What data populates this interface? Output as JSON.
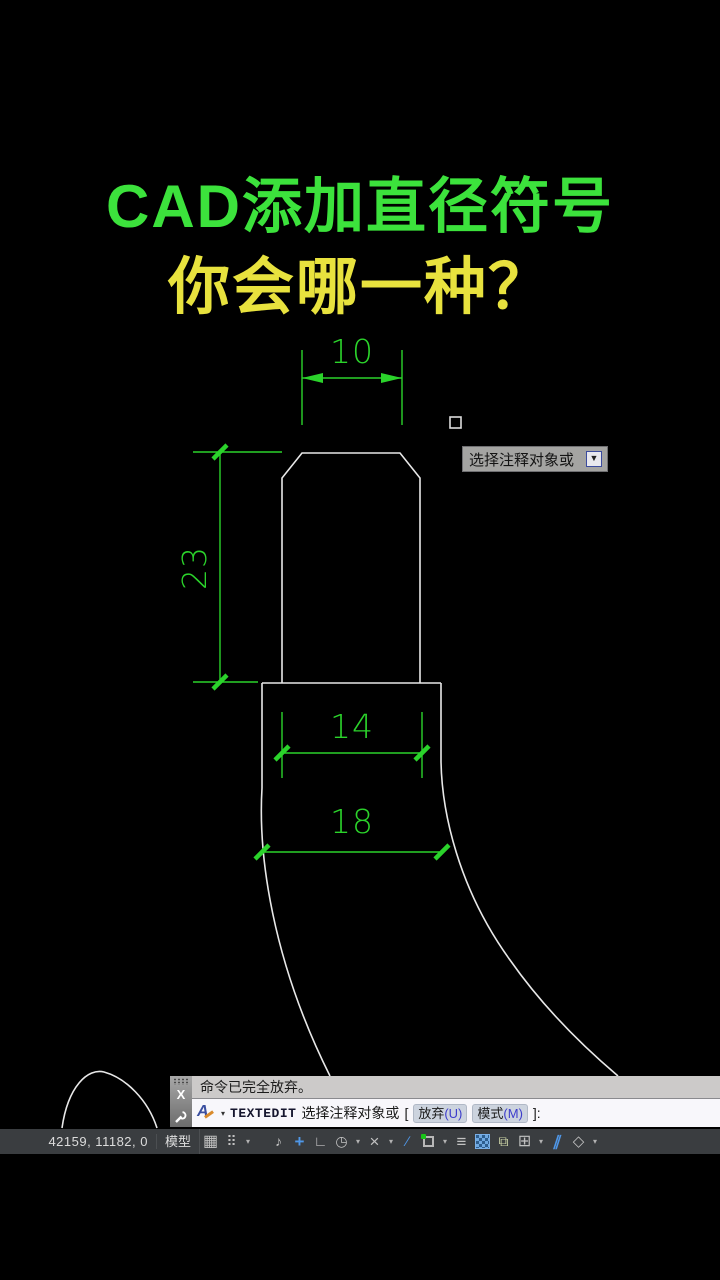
{
  "title": {
    "line1": "CAD添加直径符号",
    "line2": "你会哪一种？",
    "line1_color": "#3ce23c",
    "line2_color": "#e8e23e"
  },
  "drawing": {
    "dimension_color": "#2bd32b",
    "outline_color": "#e8e8e8",
    "dimensions": {
      "top_width": "10",
      "height": "23",
      "inner_width": "14",
      "outer_width": "18"
    }
  },
  "tooltip": {
    "text": "选择注释对象或",
    "key_icon": "▼"
  },
  "command_window": {
    "close_label": "X",
    "history_line": "命令已完全放弃。",
    "prompt": {
      "command": "TEXTEDIT",
      "text": "选择注释对象或",
      "bracket_open": "[",
      "options": [
        {
          "name": "放弃",
          "key": "(U)"
        },
        {
          "name": "模式",
          "key": "(M)"
        }
      ],
      "bracket_close": "]:",
      "caret": "▾"
    }
  },
  "status_bar": {
    "coordinates": "42159, 11182, 0",
    "model_button": "模型",
    "icons": {
      "grid": {
        "glyph": "▦"
      },
      "snap": {
        "glyph": "⠿",
        "dropdown": "▾"
      },
      "infer": {
        "glyph": "♪"
      },
      "dyninput": {
        "glyph": "+"
      },
      "ortho": {
        "glyph": "∟"
      },
      "polar": {
        "glyph": "◷",
        "dropdown": "▾"
      },
      "iso": {
        "glyph": "×",
        "dropdown": "▾"
      },
      "otrack": {
        "glyph": "∕"
      },
      "osnap": {
        "dropdown": "▾"
      },
      "lineweight": {
        "glyph": "≡"
      },
      "cycling": {
        "glyph": "⧉"
      },
      "osnap3d": {
        "glyph": "⊞",
        "dropdown": "▾"
      },
      "ducs": {
        "glyph": "∥"
      },
      "annot": {
        "glyph": "◇",
        "dropdown": "▾"
      }
    }
  }
}
